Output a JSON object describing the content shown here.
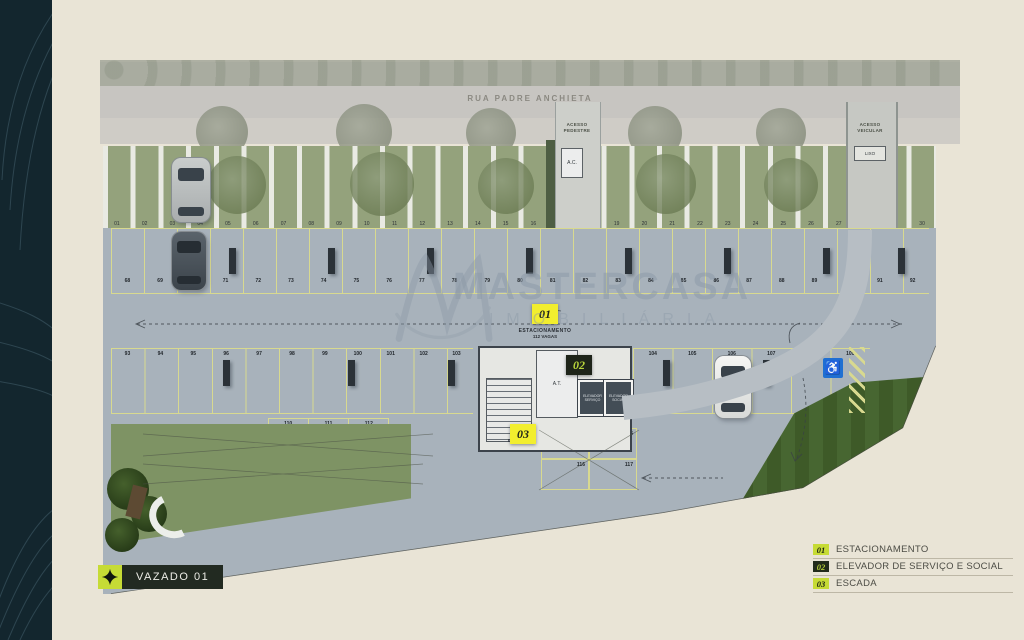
{
  "colors": {
    "background_beige": "#e9e4d6",
    "band_dark_teal": "#13262e",
    "concrete": "#a8b2bb",
    "stall_line_yellow": "#d8d98f",
    "marker_yellow": "#f2ee2e",
    "legend_yellow_green": "#c6db35",
    "badge_dark": "#222b1b",
    "accessible_blue": "#1f6fd2",
    "lawn_green": "#3e5a28",
    "watermark_gray_blue": "#8d9aa8"
  },
  "street": {
    "name": "RUA PADRE ANCHIETA",
    "pedestrian_access": "ACESSO\nPEDESTRE",
    "vehicle_access": "ACESSO\nVEICULAR",
    "ac_box": "A.C.",
    "trash_box": "LIXO"
  },
  "core": {
    "at_room": "A.T.",
    "stairs_label": "ESCADA",
    "elevator_service": "ELEVADOR SERVIÇO",
    "elevator_social": "ELEVADOR SOCIAL"
  },
  "markers": {
    "m01": {
      "num": "01",
      "caption_title": "ESTACIONAMENTO",
      "caption_sub": "112 VAGAS"
    },
    "m02": {
      "num": "02"
    },
    "m03": {
      "num": "03"
    }
  },
  "parking": {
    "row_top": [
      "01",
      "02",
      "03",
      "04",
      "05",
      "06",
      "07",
      "08",
      "09",
      "10",
      "11",
      "12",
      "13",
      "14",
      "15",
      "16",
      "17",
      "18",
      "19",
      "20",
      "21",
      "22",
      "23",
      "24",
      "25",
      "26",
      "27",
      "28",
      "29",
      "30"
    ],
    "row_a": [
      "68",
      "69",
      "70",
      "71",
      "72",
      "73",
      "74",
      "75",
      "76",
      "77",
      "78",
      "79",
      "80",
      "81",
      "82",
      "83",
      "84",
      "85",
      "86",
      "87",
      "88",
      "89",
      "90",
      "91",
      "92"
    ],
    "row_b_left": [
      "93",
      "94",
      "95",
      "96",
      "97",
      "98",
      "99",
      "100",
      "101",
      "102",
      "103"
    ],
    "row_b_right": [
      "104",
      "105",
      "106",
      "107",
      "108",
      "109"
    ],
    "row_bottom_left": [
      "110",
      "111",
      "112"
    ],
    "row_bottom_right": [
      "113",
      "115",
      "116",
      "117"
    ],
    "accessible_icon": "wheelchair"
  },
  "watermark": {
    "brand": "MASTERCASA",
    "subtitle": "IMOBILIÁRIA",
    "monogram": "M"
  },
  "footer": {
    "label": "VAZADO 01"
  },
  "legend": {
    "items": [
      {
        "num": "01",
        "label": "ESTACIONAMENTO",
        "style": "yellow"
      },
      {
        "num": "02",
        "label": "ELEVADOR DE SERVIÇO E SOCIAL",
        "style": "dark"
      },
      {
        "num": "03",
        "label": "ESCADA",
        "style": "yellow"
      }
    ]
  }
}
